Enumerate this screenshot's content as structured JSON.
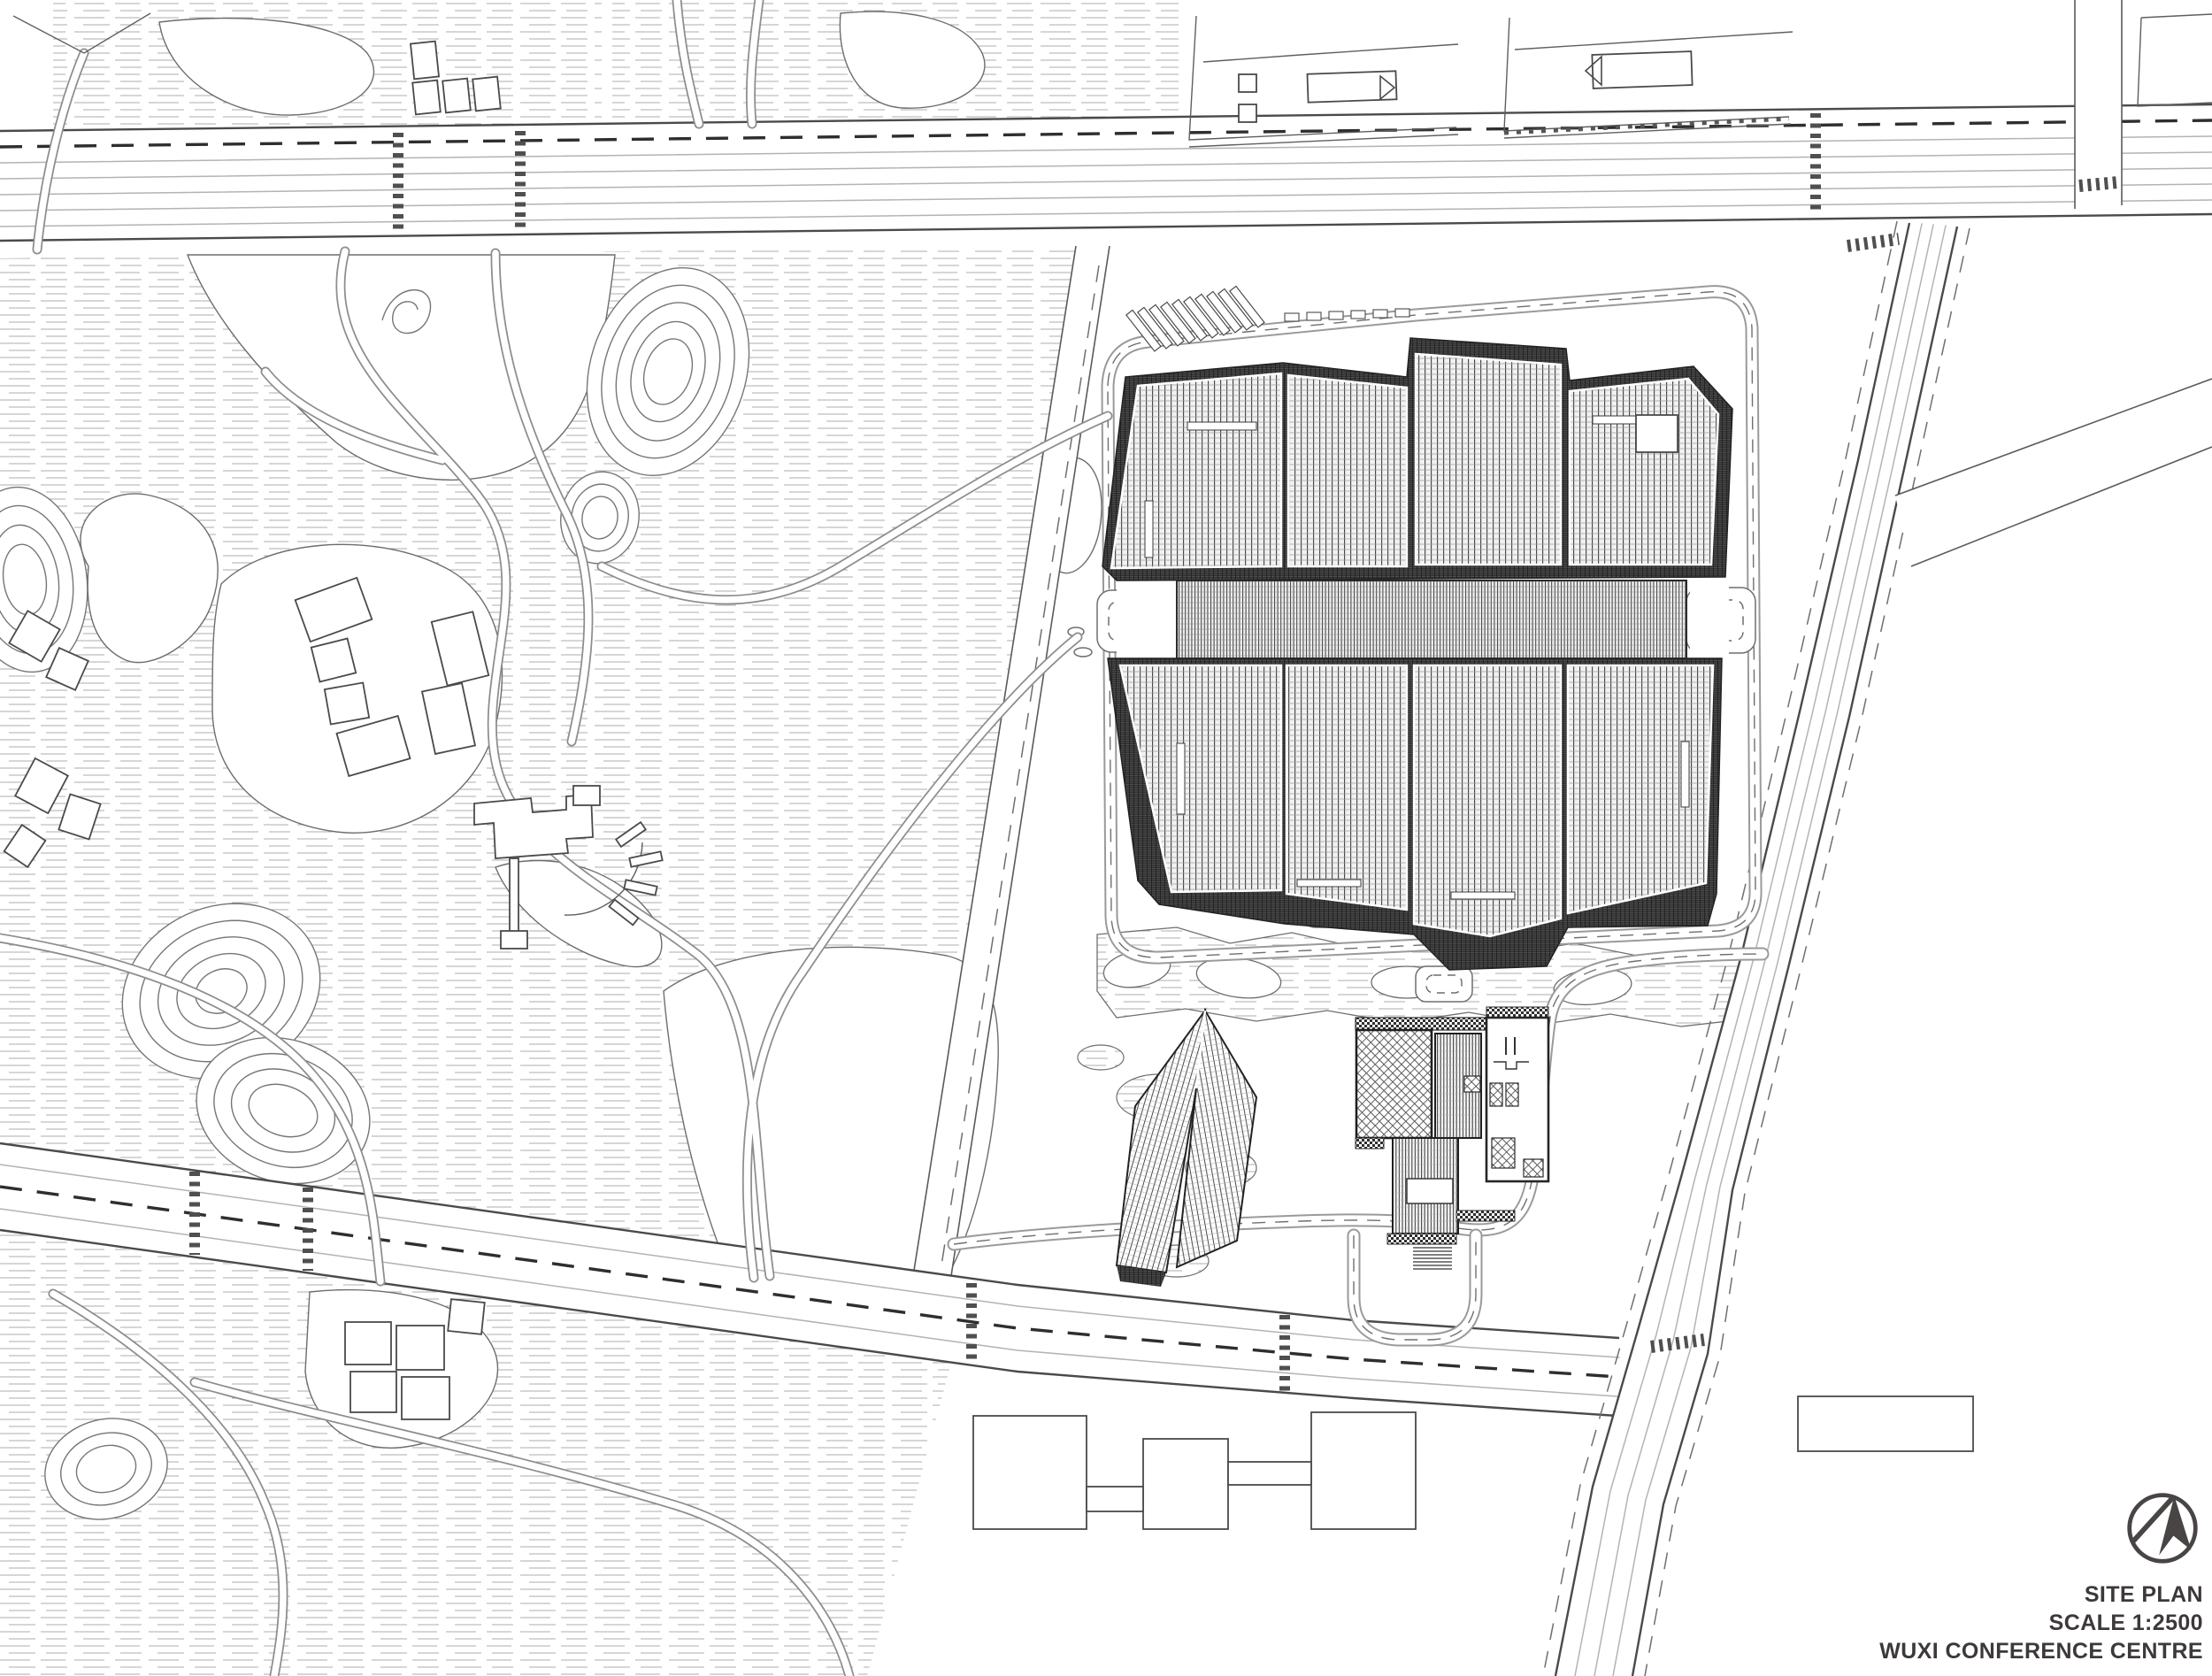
{
  "title_block": {
    "drawing_title": "SITE PLAN",
    "scale_label": "SCALE 1:2500",
    "project_name": "WUXI CONFERENCE CENTRE",
    "logo_icon": "architect-monogram-north-arrow-icon"
  },
  "drawing": {
    "type": "architectural site plan, black ink on white",
    "colors": {
      "paper": "#ffffff",
      "ink": "#4a4a4a",
      "roof_band": "#313131",
      "water_hatch": "#adadad"
    },
    "features": [
      "lakeside park with contour hills, winding paths and small pavilions (west)",
      "main conference hall: eight hatched roof bays around a striped central spine (north-east)",
      "hotel block with courtyards and folded-roof annex (south-east)",
      "top boulevard with lane lines and crosswalks",
      "south road, west park road and east multi-lane boulevard",
      "city blocks with building footprints along the north edge"
    ]
  }
}
